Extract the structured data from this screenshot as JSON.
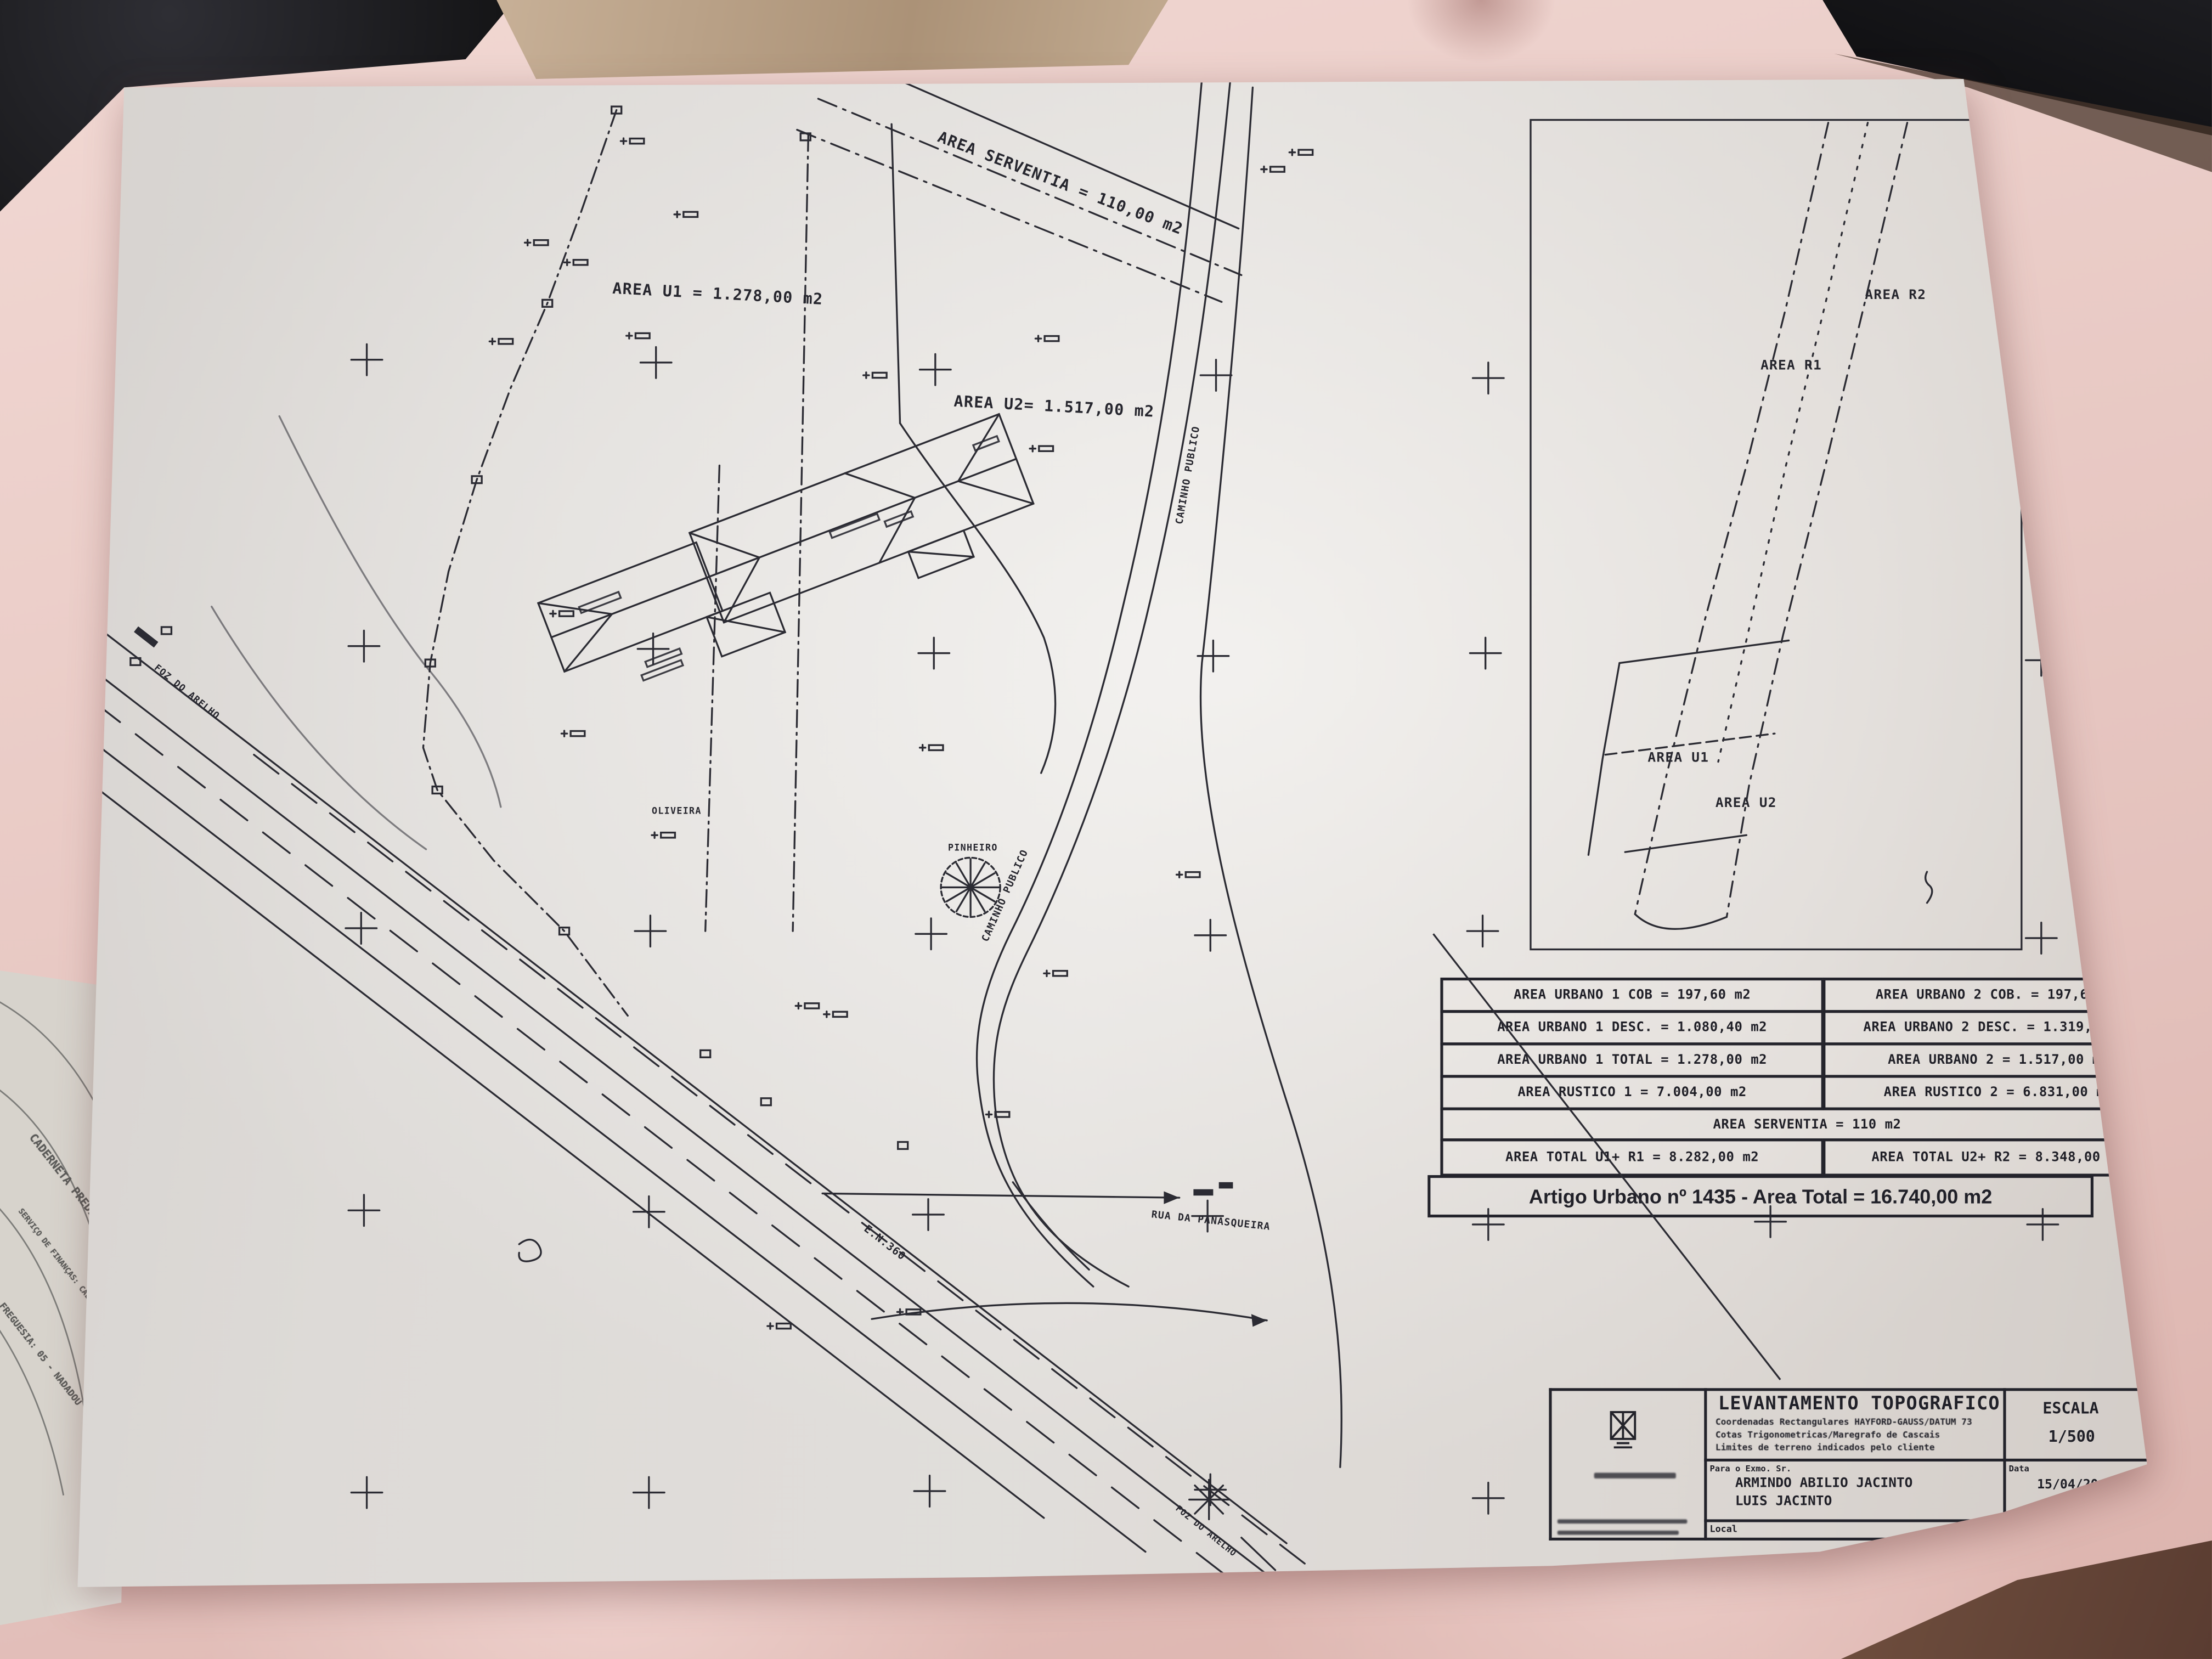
{
  "plan": {
    "area_serventia": "AREA SERVENTIA = 110,00 m2",
    "area_u1": "AREA U1 = 1.278,00 m2",
    "area_u2": "AREA U2= 1.517,00 m2",
    "caminho_publico": "CAMINHO PUBLICO",
    "rua_da_panasqueira": "RUA DA PANASQUEIRA",
    "foz_do_arelho": "FOZ DO ARELHO",
    "en360": "E.N.360",
    "oliveira": "OLIVEIRA",
    "pinheiro": "PINHEIRO",
    "keyplan": {
      "area_r2": "AREA R2",
      "area_r1": "AREA R1",
      "area_u1": "AREA U1",
      "area_u2": "AREA U2"
    }
  },
  "tables": {
    "rows": [
      {
        "left": "AREA URBANO 1 COB = 197,60 m2",
        "right": "AREA URBANO 2 COB. = 197,60 m2"
      },
      {
        "left": "AREA URBANO 1 DESC. = 1.080,40 m2",
        "right": "AREA URBANO 2 DESC. = 1.319,40 m2"
      },
      {
        "left": "AREA URBANO 1 TOTAL = 1.278,00 m2",
        "right": "AREA URBANO 2 = 1.517,00 m2"
      },
      {
        "left": "AREA RUSTICO 1 = 7.004,00 m2",
        "right": "AREA RUSTICO 2 = 6.831,00 m2"
      }
    ],
    "serventia_row": "AREA SERVENTIA = 110 m2",
    "total_left": "AREA TOTAL U1+ R1 = 8.282,00 m2",
    "total_right": "AREA TOTAL U2+ R2 = 8.348,00 m2",
    "artigo_row": "Artigo Urbano nº 1435 - Area Total = 16.740,00 m2"
  },
  "titleblock": {
    "title": "LEVANTAMENTO TOPOGRAFICO",
    "line1": "Coordenadas Rectangulares HAYFORD-GAUSS/DATUM 73",
    "line2": "Cotas Trigonometricas/Maregrafo de Cascais",
    "line3": "Limites de terreno indicados pelo cliente",
    "escala_label": "ESCALA",
    "escala_value": "1/500",
    "para_label": "Para o Exmo. Sr.",
    "client1": "ARMINDO ABILIO JACINTO",
    "client2": "LUIS JACINTO",
    "data_label": "Data",
    "data_value": "15/04/20",
    "local_label": "Local",
    "obra_label": "Obra. Nº"
  },
  "underdoc": {
    "line1": "CADERNETA PREDIAL URB",
    "line2": "SERVIÇO DE FINANÇAS: CALDAS DA RAINHA",
    "line3": "FREGUESIA: 05 - NADADOU"
  }
}
